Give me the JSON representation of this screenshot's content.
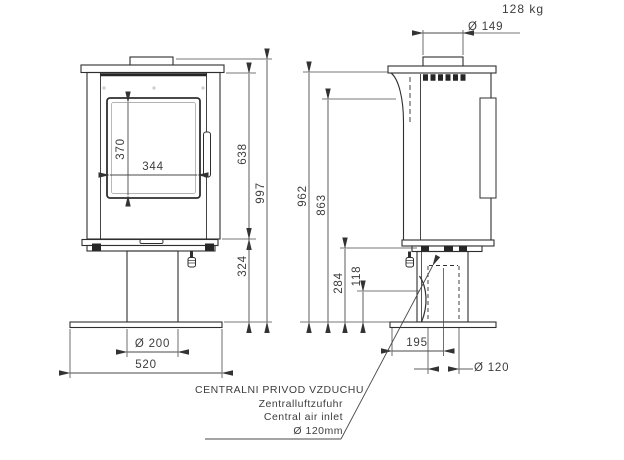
{
  "sheet": {
    "weight": "128 kg"
  },
  "dimensions": {
    "flue_collar_diameter": "Ø 149",
    "window_height": "370",
    "window_width": "344",
    "body_height": "638",
    "total_height": "997",
    "height_to_top_plate": "962",
    "height_to_flue_axis": "863",
    "pedestal_height": "324",
    "air_connection_height": "284",
    "air_pipe_height": "118",
    "pedestal_diameter": "Ø 200",
    "base_width": "520",
    "air_inlet_offset": "195",
    "air_inlet_diameter": "Ø 120"
  },
  "caption": {
    "line1": "CENTRALNI PRIVOD VZDUCHU",
    "line2": "Zentralluftzufuhr",
    "line3": "Central air inlet",
    "line4": "Ø 120mm"
  },
  "colors": {
    "outline": "#2f2f2f",
    "dimension": "#4a4a4a",
    "text": "#3d3d3d",
    "background": "#ffffff"
  }
}
